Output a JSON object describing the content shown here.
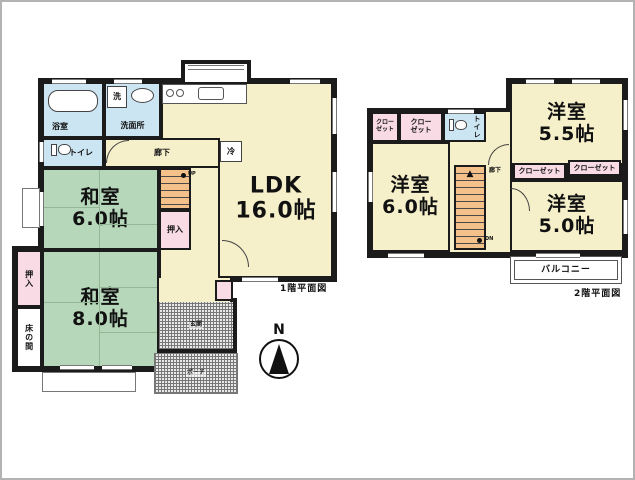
{
  "colors": {
    "wall": "#1b1b1b",
    "room_cream": "#f5efca",
    "tatami_green": "#b7d7ba",
    "wet_area_blue": "#cce5f2",
    "closet_pink": "#f8dbe4",
    "stairs_orange": "#f3c189",
    "frame_gray": "#b3b3b3"
  },
  "icons": {
    "stairs_arrow": "▲"
  },
  "compass": {
    "north": "N"
  },
  "floor1": {
    "caption": "1階平面図",
    "bath": "浴室",
    "laundry": "洗",
    "washroom": "洗面所",
    "toilet": "トイレ",
    "hallway": "廊下",
    "fridge": "冷",
    "ldk": "LDK\n16.0帖",
    "washitsu6": "和室\n6.0帖",
    "washitsu8": "和室\n8.0帖",
    "up": "UP",
    "closet_by_stairs": "押入",
    "closet_west": "押入",
    "tokonoma": "床の間",
    "entrance": "玄関",
    "porch": "ポーチ"
  },
  "floor2": {
    "caption": "2階平面図",
    "closet_nw_small": "クロー\nゼット",
    "closet_nw": "クロー\nゼット",
    "toilet": "トイレ",
    "hallway": "廊下",
    "room_ne": "洋室\n5.5帖",
    "room_w": "洋室\n6.0帖",
    "room_se": "洋室\n5.0帖",
    "closet_mid_w": "クローゼット",
    "closet_mid_e": "クローゼット",
    "dn": "DN",
    "balcony": "バルコニー"
  }
}
